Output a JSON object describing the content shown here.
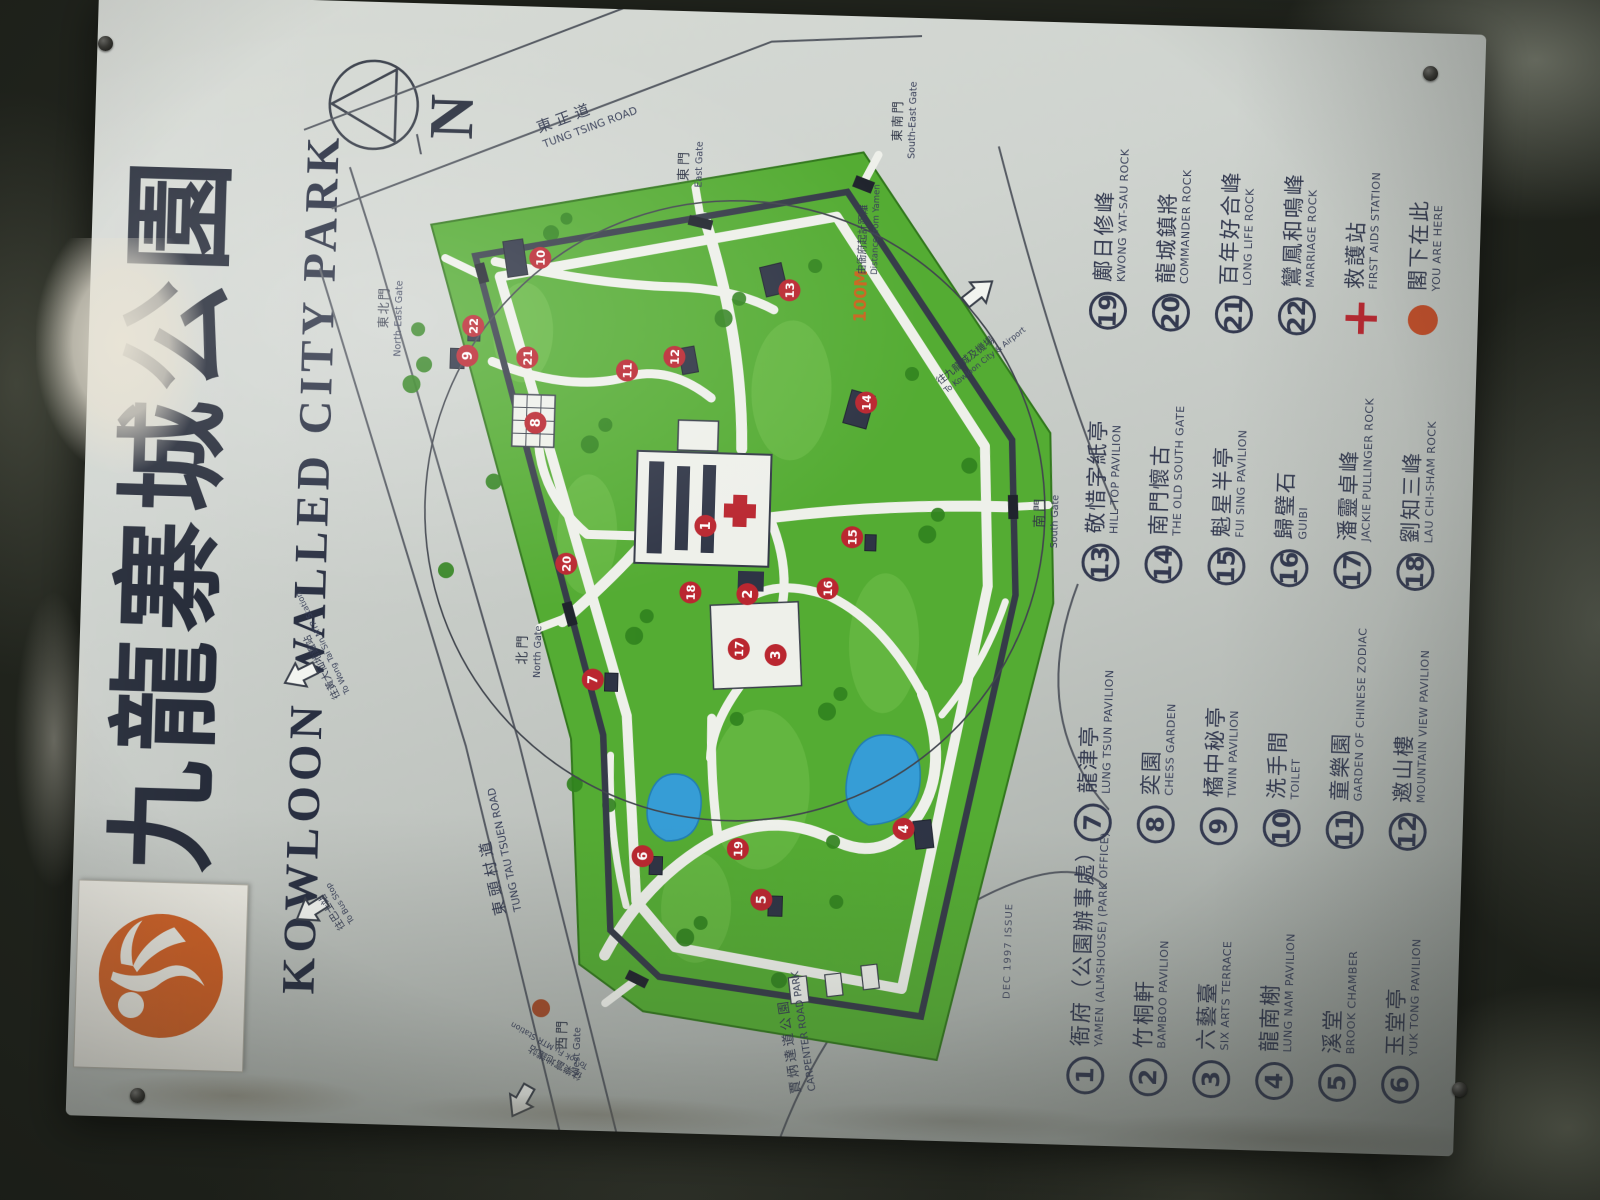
{
  "sign": {
    "title_cn": "九龍寨城公園",
    "title_en": "KOWLOON WALLED CITY PARK",
    "compass_label": "N",
    "issue_note": "DEC 1997 ISSUE",
    "logo_icon": "running-figure-logo"
  },
  "map": {
    "scale": {
      "value": "100M",
      "cn": "由衙府起計距離",
      "en": "Distance from Yamen"
    },
    "roads": {
      "tung_tsing": {
        "cn": "東正道",
        "en": "TUNG TSING ROAD"
      },
      "tung_tau_tsuen": {
        "cn": "東頭村道",
        "en": "TUNG TAU TSUEN ROAD"
      }
    },
    "adjacent_park": {
      "cn": "賈炳達道公園",
      "en": "CARPENTER ROAD PARK"
    },
    "gates": {
      "north": {
        "cn": "北門",
        "en": "North Gate"
      },
      "east": {
        "cn": "東門",
        "en": "East Gate"
      },
      "south": {
        "cn": "南門",
        "en": "South Gate"
      },
      "west": {
        "cn": "西門",
        "en": "West Gate"
      },
      "north_east": {
        "cn": "東北門",
        "en": "North-East Gate"
      },
      "south_east": {
        "cn": "東南門",
        "en": "South-East Gate"
      }
    },
    "arrows": {
      "bus_stop": {
        "cn": "往巴士站",
        "en": "To Bus Stop"
      },
      "wong_tai_sin": {
        "cn": "往黃大仙地鐵站",
        "en": "To Wong Tai Sin MTR Station"
      },
      "lok_fu": {
        "cn": "往樂富地鐵站",
        "en": "To Lok Fu MTR Station"
      },
      "kowloon_city": {
        "cn": "往九龍城及機場",
        "en": "To Kowloon City & Airport"
      }
    },
    "markers": [
      {
        "n": "1",
        "x": 612,
        "y": 418
      },
      {
        "n": "2",
        "x": 545,
        "y": 462
      },
      {
        "n": "3",
        "x": 485,
        "y": 492
      },
      {
        "n": "4",
        "x": 315,
        "y": 625
      },
      {
        "n": "5",
        "x": 240,
        "y": 485
      },
      {
        "n": "6",
        "x": 280,
        "y": 365
      },
      {
        "n": "7",
        "x": 455,
        "y": 310
      },
      {
        "n": "8",
        "x": 710,
        "y": 245
      },
      {
        "n": "9",
        "x": 775,
        "y": 175
      },
      {
        "n": "10",
        "x": 875,
        "y": 245
      },
      {
        "n": "11",
        "x": 765,
        "y": 335
      },
      {
        "n": "12",
        "x": 780,
        "y": 382
      },
      {
        "n": "13",
        "x": 850,
        "y": 495
      },
      {
        "n": "14",
        "x": 740,
        "y": 575
      },
      {
        "n": "15",
        "x": 605,
        "y": 565
      },
      {
        "n": "16",
        "x": 553,
        "y": 542
      },
      {
        "n": "17",
        "x": 490,
        "y": 455
      },
      {
        "n": "18",
        "x": 545,
        "y": 405
      },
      {
        "n": "19",
        "x": 290,
        "y": 460
      },
      {
        "n": "20",
        "x": 570,
        "y": 280
      },
      {
        "n": "21",
        "x": 775,
        "y": 235
      },
      {
        "n": "22",
        "x": 805,
        "y": 180
      }
    ],
    "you_are_here_marker": "red-dot",
    "first_aid_marker": "red-cross"
  },
  "legend": {
    "columns": [
      [
        {
          "badge": "1",
          "type": "num",
          "cn": "衙府（公園辦事處）",
          "en": "YAMEN (ALMSHOUSE) (PARK OFFICE)"
        },
        {
          "badge": "2",
          "type": "num",
          "cn": "竹桐軒",
          "en": "BAMBOO PAVILION"
        },
        {
          "badge": "3",
          "type": "num",
          "cn": "六藝臺",
          "en": "SIX ARTS TERRACE"
        },
        {
          "badge": "4",
          "type": "num",
          "cn": "龍南榭",
          "en": "LUNG NAM PAVILION"
        },
        {
          "badge": "5",
          "type": "num",
          "cn": "溪堂",
          "en": "BROOK CHAMBER"
        },
        {
          "badge": "6",
          "type": "num",
          "cn": "玉堂亭",
          "en": "YUK TONG PAVILION"
        }
      ],
      [
        {
          "badge": "7",
          "type": "num",
          "cn": "龍津亭",
          "en": "LUNG TSUN PAVILION"
        },
        {
          "badge": "8",
          "type": "num",
          "cn": "奕園",
          "en": "CHESS GARDEN"
        },
        {
          "badge": "9",
          "type": "num",
          "cn": "橘中秘亭",
          "en": "TWIN PAVILION"
        },
        {
          "badge": "10",
          "type": "num",
          "cn": "洗手間",
          "en": "TOILET"
        },
        {
          "badge": "11",
          "type": "num",
          "cn": "童樂園",
          "en": "GARDEN OF CHINESE ZODIAC"
        },
        {
          "badge": "12",
          "type": "num",
          "cn": "邀山樓",
          "en": "MOUNTAIN VIEW PAVILION"
        }
      ],
      [
        {
          "badge": "13",
          "type": "num",
          "cn": "敬惜字紙亭",
          "en": "HILL TOP PAVILION"
        },
        {
          "badge": "14",
          "type": "num",
          "cn": "南門懷古",
          "en": "THE OLD SOUTH GATE"
        },
        {
          "badge": "15",
          "type": "num",
          "cn": "魁星半亭",
          "en": "FUI SING PAVILION"
        },
        {
          "badge": "16",
          "type": "num",
          "cn": "歸璧石",
          "en": "GUIBI"
        },
        {
          "badge": "17",
          "type": "num",
          "cn": "潘靈卓峰",
          "en": "JACKIE PULLINGER ROCK"
        },
        {
          "badge": "18",
          "type": "num",
          "cn": "劉知三峰",
          "en": "LAU CHI-SHAM ROCK"
        }
      ],
      [
        {
          "badge": "19",
          "type": "num",
          "cn": "鄺日修峰",
          "en": "KWONG YAT-SAU ROCK"
        },
        {
          "badge": "20",
          "type": "num",
          "cn": "龍城鎮將",
          "en": "COMMANDER ROCK"
        },
        {
          "badge": "21",
          "type": "num",
          "cn": "百年好合峰",
          "en": "LONG LIFE ROCK"
        },
        {
          "badge": "22",
          "type": "num",
          "cn": "鸞鳳和鳴峰",
          "en": "MARRIAGE ROCK"
        },
        {
          "badge": "+",
          "type": "cross",
          "cn": "救護站",
          "en": "FIRST AIDS STATION"
        },
        {
          "badge": "",
          "type": "dot",
          "cn": "閣下在此",
          "en": "YOU ARE HERE"
        }
      ]
    ]
  },
  "colors": {
    "accent_red": "#c4242e",
    "dot_orange": "#d04b22",
    "park_green": "#4fae2b",
    "pond_blue": "#2f9fdd",
    "text_navy": "#333a52",
    "logo_orange": "#d95a17",
    "scale_orange": "#cf6418"
  }
}
